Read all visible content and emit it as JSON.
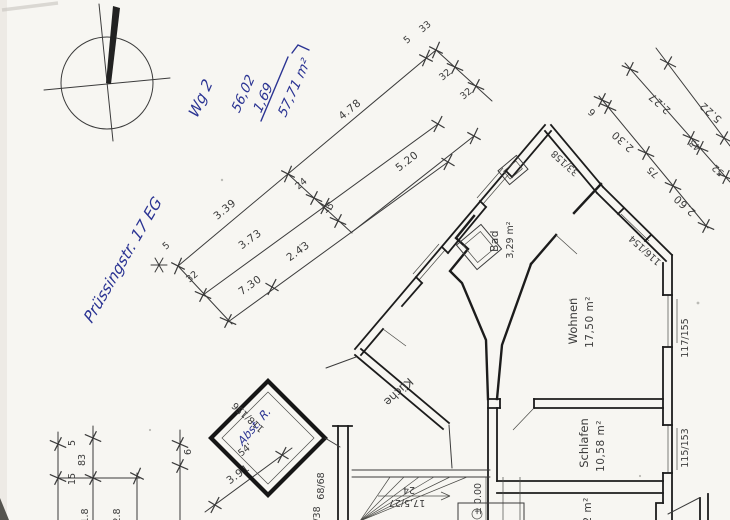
{
  "colors": {
    "paper": "#f7f6f2",
    "pencil": "#3b3b3b",
    "wall": "#1c1c1c",
    "ink": "#2b3493"
  },
  "handwriting": {
    "street_label": "Prüssingstr. 17 EG",
    "unit_label": "Wg 2",
    "area_value_1": "56,02",
    "area_value_2": "1,69",
    "area_total": "57,71 m²",
    "storage_label": "Abst. R."
  },
  "rooms": {
    "bad": {
      "name": "Bad",
      "area": "3,29 m²"
    },
    "wohnen": {
      "name": "Wohnen",
      "area": "17,50 m²"
    },
    "schlafen": {
      "name": "Schlafen",
      "area": "10,58 m²"
    },
    "kueche": {
      "name": "Küche"
    },
    "flur": {
      "area_partial": "12 m²"
    }
  },
  "stairs": {
    "steps": "24",
    "step_ratio": "17,5/27",
    "level_mark": "± 0.00",
    "code_a": "68/68",
    "code_b": "/38"
  },
  "codes": {
    "top_window": "33/158",
    "chamfer_window": "116/154",
    "right_window_upper": "117/155",
    "right_window_lower": "115/153",
    "storage_window": "118/156",
    "storage_note": "54'"
  },
  "dims": {
    "c1": [
      "3.39",
      "4.78"
    ],
    "c1_end": [
      "33",
      "5"
    ],
    "c1_start": [
      "5",
      "32"
    ],
    "c2_conn": [
      "24",
      "15"
    ],
    "c2": [
      "5.20"
    ],
    "c2_end": [
      "32",
      "32"
    ],
    "c3": [
      "3.73"
    ],
    "c4": [
      "7.30",
      "2.43"
    ],
    "r1": [
      "5.22"
    ],
    "r2": [
      "2.27",
      "43",
      "52"
    ],
    "r3": [
      "6",
      "2.30",
      "75",
      "2.60"
    ],
    "b1": [
      "5",
      "83",
      "15"
    ],
    "b1_cut": [
      "1.8",
      "2.8"
    ],
    "b2": [
      "6"
    ],
    "b3": [
      "3.91"
    ]
  }
}
